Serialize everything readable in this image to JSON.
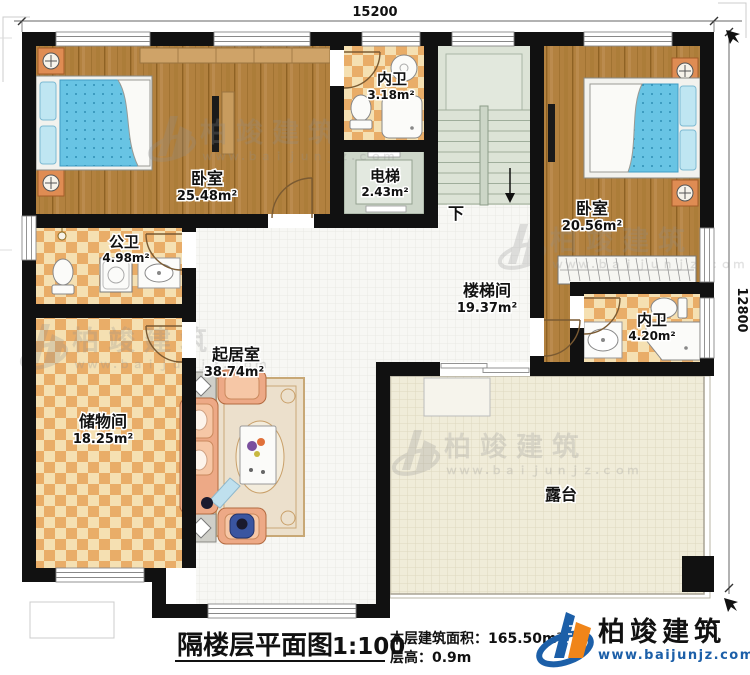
{
  "dimensions": {
    "top": "15200",
    "right": "12800"
  },
  "rooms": {
    "bedroom_left": {
      "name": "卧室",
      "area": "25.48m²"
    },
    "ensuite_top": {
      "name": "内卫",
      "area": "3.18m²"
    },
    "elevator": {
      "name": "电梯",
      "area": "2.43m²"
    },
    "bedroom_right": {
      "name": "卧室",
      "area": "20.56m²"
    },
    "ensuite_right": {
      "name": "内卫",
      "area": "4.20m²"
    },
    "public_bath": {
      "name": "公卫",
      "area": "4.98m²"
    },
    "storage": {
      "name": "储物间",
      "area": "18.25m²"
    },
    "living": {
      "name": "起居室",
      "area": "38.74m²"
    },
    "stairwell": {
      "name": "楼梯间",
      "area": "19.37m²"
    },
    "terrace": {
      "name": "露台"
    },
    "stairs_down": "下"
  },
  "caption": {
    "title": "隔楼层平面图",
    "scale": "1:100",
    "area_line": "本层建筑面积：165.50m²",
    "height_line": "层高：0.9m"
  },
  "branding": {
    "logo_name": "柏竣建筑",
    "logo_url": "www.baijunjz.com",
    "watermark_name": "柏竣建筑",
    "watermark_url": "ｗｗｗ.ｂａｉｊｕｎｊｚ.ｃｏｍ"
  },
  "colors": {
    "wall": "#111111",
    "wood_floor": "#b2813f",
    "tile_light": "#f5e0b2",
    "tile_dark": "#e9ad68",
    "living_floor": "#f7f7f4",
    "terrace_floor": "#f0ecd9",
    "stair_floor": "#dce3d6",
    "bed_blue": "#68c4e4",
    "nightstand_orange": "#df8c53",
    "sofa_peach": "#eda986",
    "logo_blue": "#1c5fa8",
    "logo_orange": "#f08519"
  }
}
